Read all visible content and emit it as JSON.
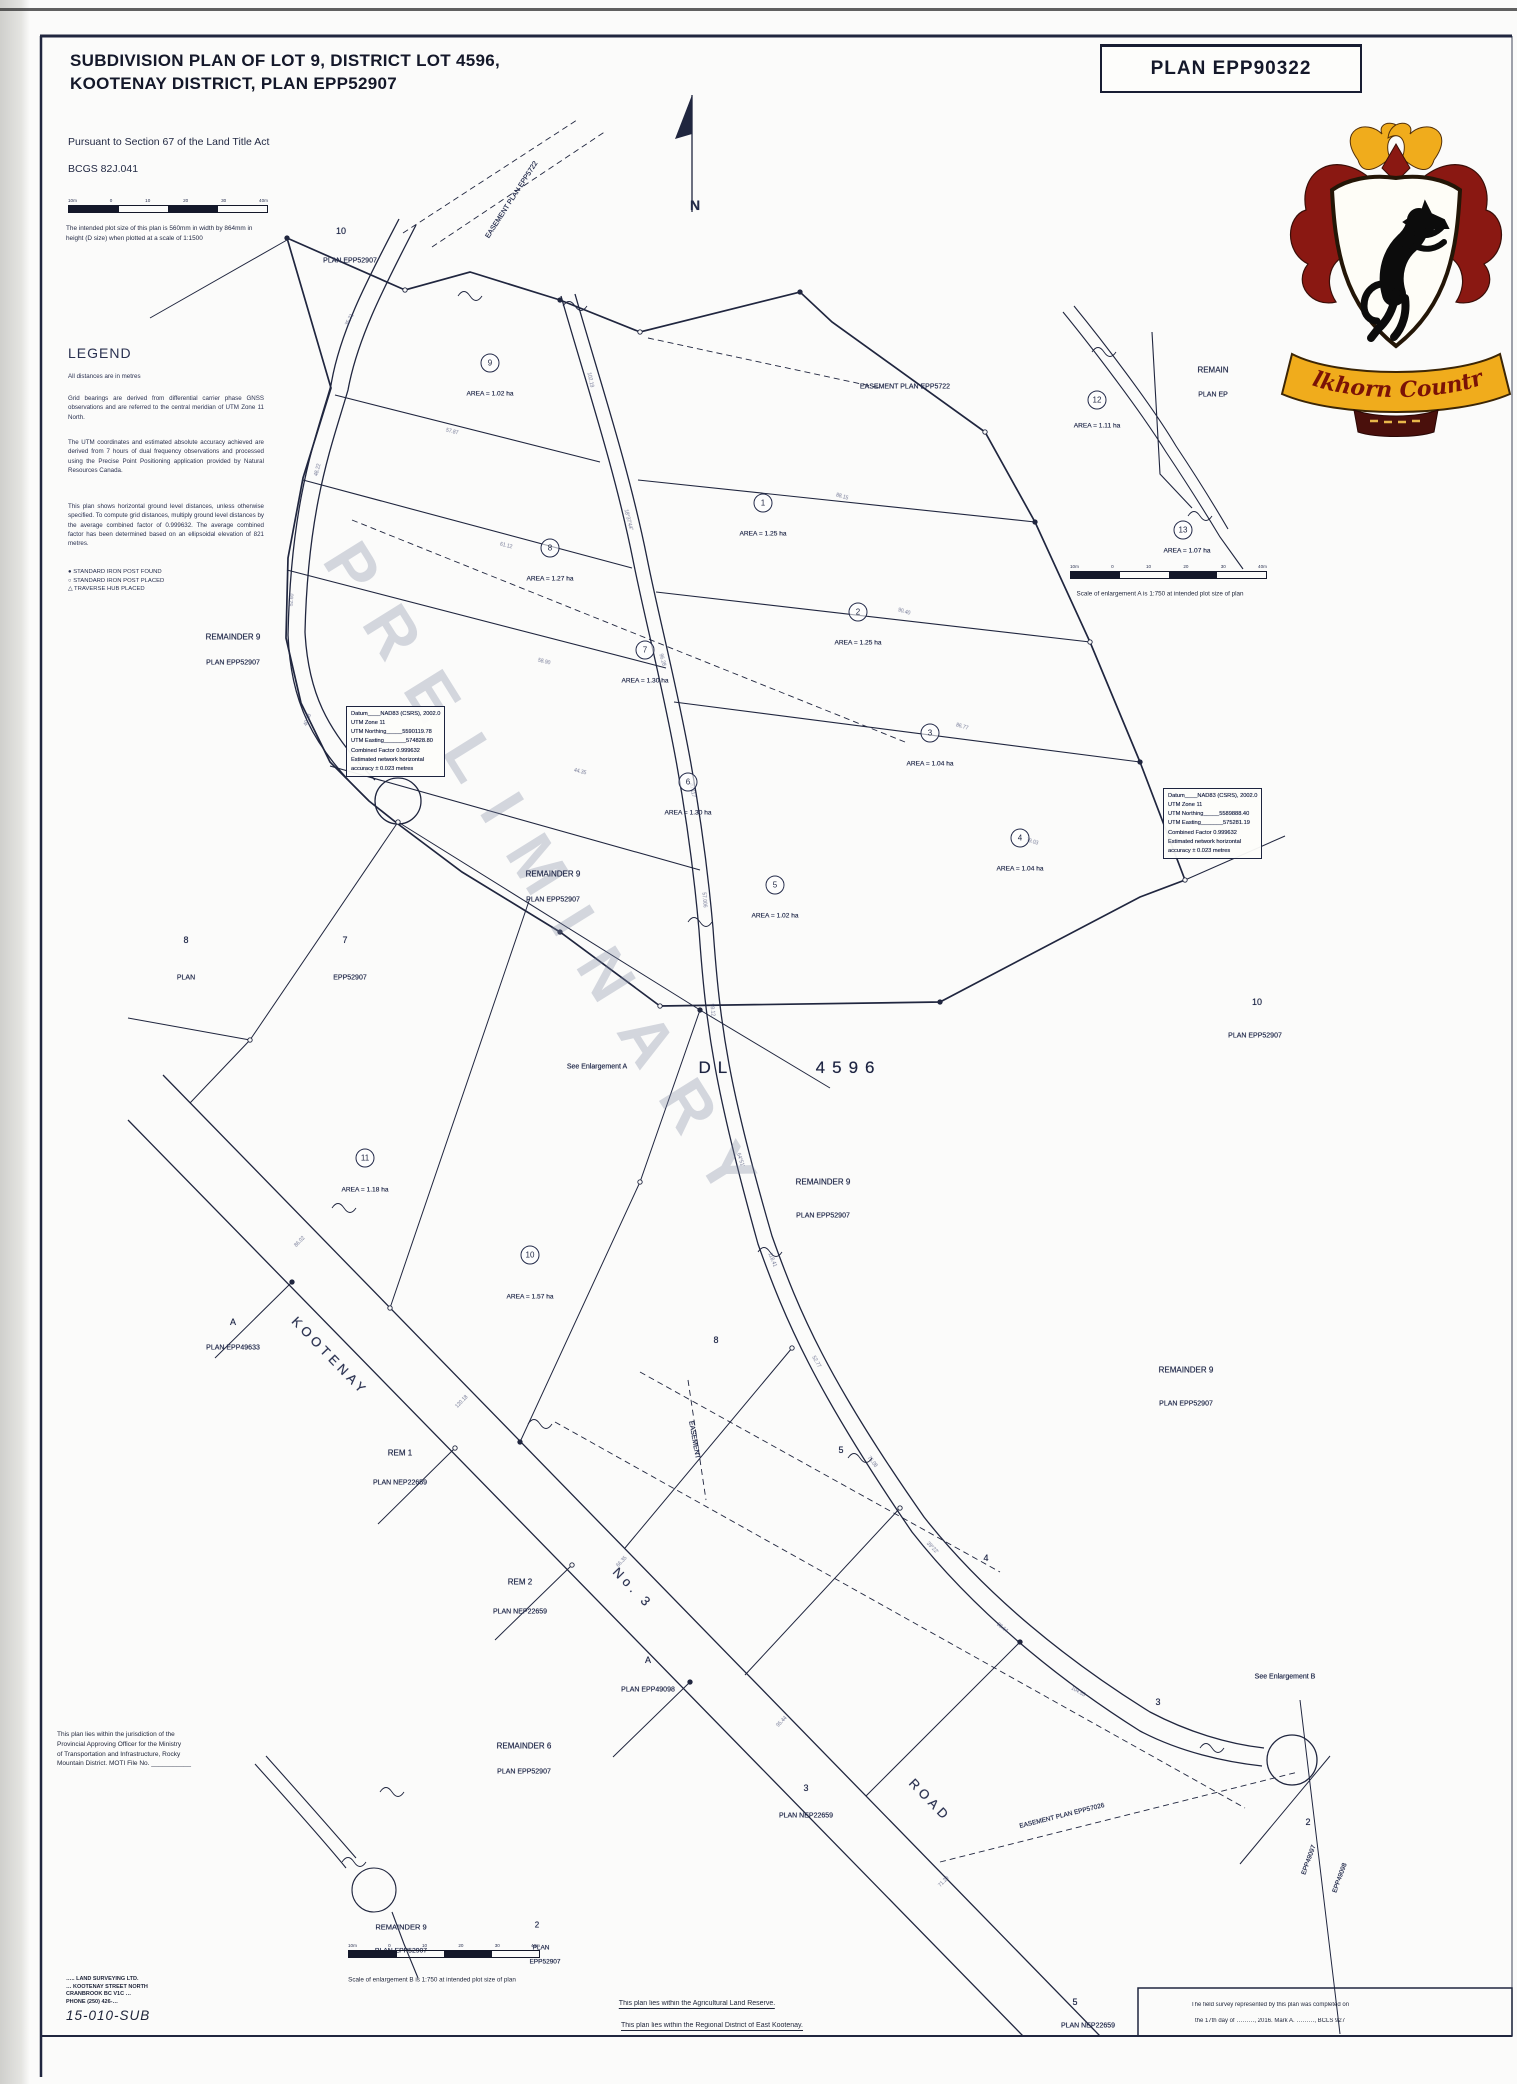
{
  "header": {
    "title1": "SUBDIVISION PLAN OF LOT 9, DISTRICT LOT 4596,",
    "title2": "KOOTENAY DISTRICT, PLAN EPP52907",
    "pursuant": "Pursuant to Section 67 of the Land Title Act",
    "bcgs": "BCGS   82J.041",
    "plot_note": "The intended plot size of this plan is 560mm in width by 864mm in height (D size) when plotted at a scale of 1:1500"
  },
  "plan_box": {
    "label": "PLAN EPP90322"
  },
  "watermark": {
    "text": "PRELIMINARY"
  },
  "crest": {
    "banner": "Elkhorn Country"
  },
  "legend": {
    "heading": "LEGEND",
    "distances": "All distances are in metres",
    "para1": "Grid bearings are derived from differential carrier phase GNSS observations and are referred to the central meridian of UTM Zone 11 North.",
    "para2": "The UTM coordinates and estimated absolute accuracy achieved are derived from 7 hours of dual frequency observations and processed using the Precise Point Positioning application provided by Natural Resources Canada.",
    "para3": "This plan shows horizontal ground level distances, unless otherwise specified. To compute grid distances, multiply ground level distances by the average combined factor of 0.999632. The average combined factor has been determined based on an ellipsoidal elevation of 821 metres.",
    "symbols": [
      {
        "glyph": "●",
        "label": "STANDARD IRON POST FOUND"
      },
      {
        "glyph": "○",
        "label": "STANDARD IRON POST PLACED"
      },
      {
        "glyph": "△",
        "label": "TRAVERSE HUB PLACED"
      }
    ]
  },
  "datum_boxes": [
    {
      "x": 346,
      "y": 706,
      "lines": [
        "Datum____NAD83 (CSRS), 2002.0",
        "UTM Zone 11",
        "UTM Northing_____5590119.78",
        "UTM Easting_______574828.80",
        "Combined Factor 0.999632",
        "Estimated network horizontal",
        "accuracy ± 0.023 metres"
      ]
    },
    {
      "x": 1163,
      "y": 788,
      "lines": [
        "Datum____NAD83 (CSRS), 2002.0",
        "UTM Zone 11",
        "UTM Northing_____5589888.40",
        "UTM Easting_______575281.19",
        "Combined Factor 0.999632",
        "Estimated network horizontal",
        "accuracy ± 0.023 metres"
      ]
    }
  ],
  "lots": [
    {
      "n": "9",
      "area": "AREA = 1.02 ha",
      "cx": 490,
      "cy": 363,
      "ax": 490,
      "ay": 394
    },
    {
      "n": "1",
      "area": "AREA = 1.25 ha",
      "cx": 763,
      "cy": 503,
      "ax": 763,
      "ay": 534
    },
    {
      "n": "8",
      "area": "AREA = 1.27 ha",
      "cx": 550,
      "cy": 548,
      "ax": 550,
      "ay": 579
    },
    {
      "n": "2",
      "area": "AREA = 1.25 ha",
      "cx": 858,
      "cy": 612,
      "ax": 858,
      "ay": 643
    },
    {
      "n": "7",
      "area": "AREA = 1.30 ha",
      "cx": 645,
      "cy": 650,
      "ax": 645,
      "ay": 681
    },
    {
      "n": "3",
      "area": "AREA = 1.04 ha",
      "cx": 930,
      "cy": 733,
      "ax": 930,
      "ay": 764
    },
    {
      "n": "6",
      "area": "AREA = 1.30 ha",
      "cx": 688,
      "cy": 782,
      "ax": 688,
      "ay": 813
    },
    {
      "n": "4",
      "area": "AREA = 1.04 ha",
      "cx": 1020,
      "cy": 838,
      "ax": 1020,
      "ay": 869
    },
    {
      "n": "5",
      "area": "AREA = 1.02 ha",
      "cx": 775,
      "cy": 885,
      "ax": 775,
      "ay": 916
    },
    {
      "n": "11",
      "area": "AREA = 1.18 ha",
      "cx": 365,
      "cy": 1158,
      "ax": 365,
      "ay": 1190
    },
    {
      "n": "10",
      "area": "AREA = 1.57 ha",
      "cx": 530,
      "cy": 1255,
      "ax": 530,
      "ay": 1297
    },
    {
      "n": "12",
      "area": "AREA = 1.11 ha",
      "cx": 1097,
      "cy": 400,
      "ax": 1097,
      "ay": 426
    },
    {
      "n": "13",
      "area": "AREA = 1.07 ha",
      "cx": 1183,
      "cy": 530,
      "ax": 1187,
      "ay": 551
    }
  ],
  "plan_labels": [
    {
      "t": "10",
      "x": 341,
      "y": 231,
      "s": 9
    },
    {
      "t": "PLAN EPP52907",
      "x": 350,
      "y": 261,
      "s": 7
    },
    {
      "t": "EASEMENT PLAN EPP5722",
      "x": 512,
      "y": 200,
      "s": 7,
      "r": -57
    },
    {
      "t": "EASEMENT PLAN EPP5722",
      "x": 905,
      "y": 387,
      "s": 7
    },
    {
      "t": "REMAINDER 9",
      "x": 233,
      "y": 637,
      "s": 8
    },
    {
      "t": "PLAN EPP52907",
      "x": 233,
      "y": 663,
      "s": 7
    },
    {
      "t": "REMAINDER 9",
      "x": 553,
      "y": 874,
      "s": 8
    },
    {
      "t": "PLAN EPP52907",
      "x": 553,
      "y": 900,
      "s": 7
    },
    {
      "t": "8",
      "x": 186,
      "y": 940,
      "s": 9
    },
    {
      "t": "7",
      "x": 345,
      "y": 940,
      "s": 9
    },
    {
      "t": "PLAN",
      "x": 186,
      "y": 978,
      "s": 7
    },
    {
      "t": "EPP52907",
      "x": 350,
      "y": 978,
      "s": 7
    },
    {
      "t": "DL       4596",
      "x": 790,
      "y": 1068,
      "s": 17,
      "c": "big"
    },
    {
      "t": "See Enlargement A",
      "x": 597,
      "y": 1067,
      "s": 7
    },
    {
      "t": "REMAINDER 9",
      "x": 823,
      "y": 1182,
      "s": 8
    },
    {
      "t": "PLAN EPP52907",
      "x": 823,
      "y": 1216,
      "s": 7
    },
    {
      "t": "10",
      "x": 1257,
      "y": 1002,
      "s": 9
    },
    {
      "t": "PLAN EPP52907",
      "x": 1255,
      "y": 1036,
      "s": 7
    },
    {
      "t": "REMAINDER 9",
      "x": 1186,
      "y": 1370,
      "s": 8
    },
    {
      "t": "PLAN EPP52907",
      "x": 1186,
      "y": 1404,
      "s": 7
    },
    {
      "t": "KOOTENAY",
      "x": 330,
      "y": 1356,
      "s": 13,
      "r": 46,
      "c": "road"
    },
    {
      "t": "No. 3",
      "x": 633,
      "y": 1588,
      "s": 13,
      "r": 46,
      "c": "road"
    },
    {
      "t": "ROAD",
      "x": 930,
      "y": 1800,
      "s": 13,
      "r": 46,
      "c": "road"
    },
    {
      "t": "A",
      "x": 233,
      "y": 1322,
      "s": 9
    },
    {
      "t": "PLAN EPP49633",
      "x": 233,
      "y": 1348,
      "s": 7
    },
    {
      "t": "REM 1",
      "x": 400,
      "y": 1453,
      "s": 8
    },
    {
      "t": "PLAN NEP22659",
      "x": 400,
      "y": 1483,
      "s": 7
    },
    {
      "t": "REM 2",
      "x": 520,
      "y": 1582,
      "s": 8
    },
    {
      "t": "PLAN NEP22659",
      "x": 520,
      "y": 1612,
      "s": 7
    },
    {
      "t": "A",
      "x": 648,
      "y": 1660,
      "s": 9
    },
    {
      "t": "PLAN EPP49098",
      "x": 648,
      "y": 1690,
      "s": 7
    },
    {
      "t": "5",
      "x": 841,
      "y": 1450,
      "s": 9
    },
    {
      "t": "4",
      "x": 986,
      "y": 1558,
      "s": 9
    },
    {
      "t": "3",
      "x": 806,
      "y": 1788,
      "s": 9
    },
    {
      "t": "PLAN NEP22659",
      "x": 806,
      "y": 1816,
      "s": 7
    },
    {
      "t": "3",
      "x": 1158,
      "y": 1702,
      "s": 9
    },
    {
      "t": "2",
      "x": 1308,
      "y": 1822,
      "s": 9
    },
    {
      "t": "5",
      "x": 1075,
      "y": 2002,
      "s": 9
    },
    {
      "t": "PLAN NEP22659",
      "x": 1088,
      "y": 2026,
      "s": 7
    },
    {
      "t": "8",
      "x": 716,
      "y": 1340,
      "s": 9
    },
    {
      "t": "EASEMENT",
      "x": 694,
      "y": 1440,
      "s": 7,
      "r": 80
    },
    {
      "t": "EASEMENT PLAN EPP57026",
      "x": 1062,
      "y": 1816,
      "s": 6.5,
      "r": -14
    },
    {
      "t": "See Enlargement B",
      "x": 1285,
      "y": 1677,
      "s": 7
    },
    {
      "t": "REMAINDER 6",
      "x": 524,
      "y": 1746,
      "s": 8
    },
    {
      "t": "PLAN EPP52907",
      "x": 524,
      "y": 1772,
      "s": 7
    },
    {
      "t": "REMAINDER 9",
      "x": 401,
      "y": 1927,
      "s": 7.5
    },
    {
      "t": "PLAN EPP52907",
      "x": 401,
      "y": 1951,
      "s": 6.8
    },
    {
      "t": "2",
      "x": 537,
      "y": 1925,
      "s": 8
    },
    {
      "t": "PLAN",
      "x": 541,
      "y": 1948,
      "s": 6.5
    },
    {
      "t": "EPP52907",
      "x": 545,
      "y": 1962,
      "s": 6.5
    },
    {
      "t": "REMAIN",
      "x": 1213,
      "y": 370,
      "s": 8
    },
    {
      "t": "PLAN EP",
      "x": 1213,
      "y": 395,
      "s": 7
    },
    {
      "t": "EPP49097",
      "x": 1309,
      "y": 1860,
      "s": 6.5,
      "r": -70
    },
    {
      "t": "EPP49098",
      "x": 1340,
      "y": 1878,
      "s": 6.5,
      "r": -70
    },
    {
      "t": "N",
      "x": 695,
      "y": 205,
      "s": 14,
      "c": "north"
    }
  ],
  "ticks": [
    {
      "t": "102.19",
      "x": 590,
      "y": 380,
      "r": 78
    },
    {
      "t": "18°37′44″",
      "x": 628,
      "y": 520,
      "r": 76
    },
    {
      "t": "96.28",
      "x": 662,
      "y": 660,
      "r": 74
    },
    {
      "t": "20.117",
      "x": 692,
      "y": 790,
      "r": 80
    },
    {
      "t": "57.006",
      "x": 704,
      "y": 900,
      "r": 85
    },
    {
      "t": "99.12",
      "x": 712,
      "y": 1010,
      "r": 84
    },
    {
      "t": "64°51′",
      "x": 740,
      "y": 1160,
      "r": 72
    },
    {
      "t": "118.41",
      "x": 772,
      "y": 1260,
      "r": 68
    },
    {
      "t": "52.77",
      "x": 816,
      "y": 1362,
      "r": 60
    },
    {
      "t": "75.08",
      "x": 872,
      "y": 1462,
      "r": 52
    },
    {
      "t": "39°22′",
      "x": 932,
      "y": 1548,
      "r": 46
    },
    {
      "t": "88.64",
      "x": 1002,
      "y": 1628,
      "r": 38
    },
    {
      "t": "104.55",
      "x": 1078,
      "y": 1692,
      "r": 30
    },
    {
      "t": "86.02",
      "x": 300,
      "y": 1242,
      "r": -46
    },
    {
      "t": "120.18",
      "x": 462,
      "y": 1402,
      "r": -46
    },
    {
      "t": "66.35",
      "x": 622,
      "y": 1562,
      "r": -46
    },
    {
      "t": "95.44",
      "x": 782,
      "y": 1722,
      "r": -46
    },
    {
      "t": "71.29",
      "x": 944,
      "y": 1882,
      "r": -46
    },
    {
      "t": "57.87",
      "x": 452,
      "y": 432,
      "r": 14
    },
    {
      "t": "61.12",
      "x": 506,
      "y": 546,
      "r": 14
    },
    {
      "t": "58.90",
      "x": 544,
      "y": 662,
      "r": 14
    },
    {
      "t": "44.35",
      "x": 580,
      "y": 772,
      "r": 14
    },
    {
      "t": "88.15",
      "x": 842,
      "y": 497,
      "r": 17
    },
    {
      "t": "90.40",
      "x": 904,
      "y": 612,
      "r": 17
    },
    {
      "t": "86.77",
      "x": 962,
      "y": 727,
      "r": 17
    },
    {
      "t": "79.03",
      "x": 1032,
      "y": 842,
      "r": 17
    },
    {
      "t": "35.71",
      "x": 350,
      "y": 320,
      "r": -62
    },
    {
      "t": "48.22",
      "x": 318,
      "y": 470,
      "r": -75
    },
    {
      "t": "52.60",
      "x": 292,
      "y": 600,
      "r": -85
    },
    {
      "t": "40.18",
      "x": 308,
      "y": 720,
      "r": -70
    }
  ],
  "scalebars": [
    {
      "x": 68,
      "y": 199,
      "w": 200,
      "labels": [
        "10m",
        "0",
        "10",
        "20",
        "30",
        "40m"
      ]
    },
    {
      "x": 1070,
      "y": 565,
      "w": 197,
      "labels": [
        "10m",
        "0",
        "10",
        "20",
        "30",
        "40m"
      ]
    },
    {
      "x": 348,
      "y": 1944,
      "w": 192,
      "labels": [
        "10m",
        "0",
        "10",
        "20",
        "30",
        "40m"
      ]
    }
  ],
  "enlargeA": {
    "caption": "Scale of enlargement A is 1:750 at intended plot size of plan"
  },
  "enlargeB": {
    "caption": "Scale of enlargement B is 1:750 at intended plot size of plan"
  },
  "notes": {
    "moti": [
      "This plan lies within the jurisdiction of the",
      "Provincial Approving Officer for the Ministry",
      "of Transportation and Infrastructure, Rocky",
      "Mountain District.   MOTI File No. ___________"
    ],
    "alr": "This plan lies within the Agricultural Land Reserve.",
    "rdek": "This plan lies within the Regional District of East Kootenay.",
    "survey1": "The field survey represented by this plan was completed on",
    "survey2": "the 17th day of ………, 2016.   Mark A. ………, BCLS 927",
    "firm": [
      "….. LAND SURVEYING LTD.",
      "… KOOTENAY STREET NORTH",
      "CRANBROOK BC  V1C …",
      "PHONE (250) 426-…"
    ],
    "file_no": "15-010-SUB"
  }
}
